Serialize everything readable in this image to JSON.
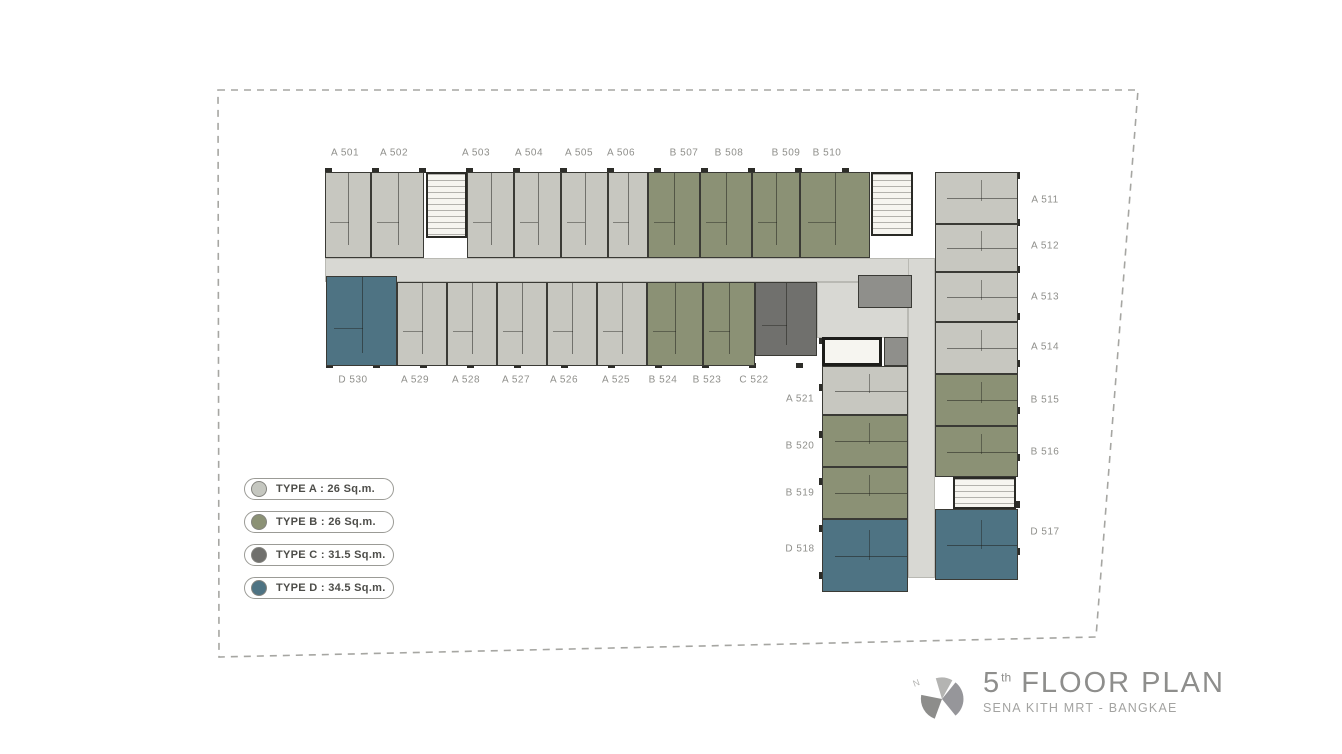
{
  "titleblock": {
    "floor_number": "5",
    "floor_suffix": "th",
    "floor_label": " FLOOR PLAN",
    "project_name": "SENA KITH MRT - BANGKAE",
    "logo_name": "sena-pinwheel-logo"
  },
  "legend": {
    "items": [
      {
        "type": "A",
        "label": "TYPE A : 26 Sq.m.",
        "color": "#c5c7c0"
      },
      {
        "type": "B",
        "label": "TYPE B : 26 Sq.m.",
        "color": "#8b9175"
      },
      {
        "type": "C",
        "label": "TYPE C : 31.5 Sq.m.",
        "color": "#70706d"
      },
      {
        "type": "D",
        "label": "TYPE D : 34.5 Sq.m.",
        "color": "#4e7383"
      }
    ]
  },
  "plan": {
    "colors": {
      "A": "#c7c7c0",
      "B": "#8b9175",
      "C": "#70706d",
      "D": "#4e7383",
      "corridor": "#d8d8d3",
      "core": "#f6f5f0",
      "wall": "#30302c"
    },
    "corridors": [
      {
        "x": 325,
        "y": 258,
        "w": 610,
        "h": 24
      },
      {
        "x": 908,
        "y": 258,
        "w": 27,
        "h": 320
      },
      {
        "x": 817,
        "y": 282,
        "w": 91,
        "h": 56
      }
    ],
    "units": [
      {
        "id": "A501",
        "type": "A",
        "o": "h",
        "x": 325,
        "y": 172,
        "w": 46,
        "h": 86
      },
      {
        "id": "A502",
        "type": "A",
        "o": "h",
        "x": 371,
        "y": 172,
        "w": 53,
        "h": 86
      },
      {
        "id": "A503",
        "type": "A",
        "o": "h",
        "x": 467,
        "y": 172,
        "w": 47,
        "h": 86
      },
      {
        "id": "A504",
        "type": "A",
        "o": "h",
        "x": 514,
        "y": 172,
        "w": 47,
        "h": 86
      },
      {
        "id": "A505",
        "type": "A",
        "o": "h",
        "x": 561,
        "y": 172,
        "w": 47,
        "h": 86
      },
      {
        "id": "A506",
        "type": "A",
        "o": "h",
        "x": 608,
        "y": 172,
        "w": 40,
        "h": 86
      },
      {
        "id": "B507",
        "type": "B",
        "o": "h",
        "x": 648,
        "y": 172,
        "w": 52,
        "h": 86
      },
      {
        "id": "B508",
        "type": "B",
        "o": "h",
        "x": 700,
        "y": 172,
        "w": 52,
        "h": 86
      },
      {
        "id": "B509",
        "type": "B",
        "o": "h",
        "x": 752,
        "y": 172,
        "w": 48,
        "h": 86
      },
      {
        "id": "B510",
        "type": "B",
        "o": "h",
        "x": 800,
        "y": 172,
        "w": 70,
        "h": 86
      },
      {
        "id": "A511",
        "type": "A",
        "o": "v",
        "x": 935,
        "y": 172,
        "w": 83,
        "h": 52
      },
      {
        "id": "A512",
        "type": "A",
        "o": "v",
        "x": 935,
        "y": 224,
        "w": 83,
        "h": 48
      },
      {
        "id": "A513",
        "type": "A",
        "o": "v",
        "x": 935,
        "y": 272,
        "w": 83,
        "h": 50
      },
      {
        "id": "A514",
        "type": "A",
        "o": "v",
        "x": 935,
        "y": 322,
        "w": 83,
        "h": 52
      },
      {
        "id": "B515",
        "type": "B",
        "o": "v",
        "x": 935,
        "y": 374,
        "w": 83,
        "h": 52
      },
      {
        "id": "B516",
        "type": "B",
        "o": "v",
        "x": 935,
        "y": 426,
        "w": 83,
        "h": 51
      },
      {
        "id": "D517",
        "type": "D",
        "o": "v",
        "x": 935,
        "y": 509,
        "w": 83,
        "h": 71
      },
      {
        "id": "A521",
        "type": "A",
        "o": "v",
        "x": 822,
        "y": 366,
        "w": 86,
        "h": 49
      },
      {
        "id": "B520",
        "type": "B",
        "o": "v",
        "x": 822,
        "y": 415,
        "w": 86,
        "h": 52
      },
      {
        "id": "B519",
        "type": "B",
        "o": "v",
        "x": 822,
        "y": 467,
        "w": 86,
        "h": 52
      },
      {
        "id": "D518",
        "type": "D",
        "o": "v",
        "x": 822,
        "y": 519,
        "w": 86,
        "h": 73
      },
      {
        "id": "C522",
        "type": "C",
        "o": "h",
        "x": 755,
        "y": 282,
        "w": 62,
        "h": 74
      },
      {
        "id": "B523",
        "type": "B",
        "o": "h",
        "x": 703,
        "y": 282,
        "w": 52,
        "h": 84
      },
      {
        "id": "B524",
        "type": "B",
        "o": "h",
        "x": 647,
        "y": 282,
        "w": 56,
        "h": 84
      },
      {
        "id": "A525",
        "type": "A",
        "o": "h",
        "x": 597,
        "y": 282,
        "w": 50,
        "h": 84
      },
      {
        "id": "A526",
        "type": "A",
        "o": "h",
        "x": 547,
        "y": 282,
        "w": 50,
        "h": 84
      },
      {
        "id": "A527",
        "type": "A",
        "o": "h",
        "x": 497,
        "y": 282,
        "w": 50,
        "h": 84
      },
      {
        "id": "A528",
        "type": "A",
        "o": "h",
        "x": 447,
        "y": 282,
        "w": 50,
        "h": 84
      },
      {
        "id": "A529",
        "type": "A",
        "o": "h",
        "x": 397,
        "y": 282,
        "w": 50,
        "h": 84
      },
      {
        "id": "D530",
        "type": "D",
        "o": "h",
        "x": 326,
        "y": 276,
        "w": 71,
        "h": 90
      }
    ],
    "cores": [
      {
        "id": "stair-core-top-left",
        "kind": "stair",
        "x": 426,
        "y": 172,
        "w": 41,
        "h": 66
      },
      {
        "id": "stair-core-top-right",
        "kind": "stair",
        "x": 871,
        "y": 172,
        "w": 42,
        "h": 64
      },
      {
        "id": "mech-room",
        "kind": "mech",
        "x": 858,
        "y": 275,
        "w": 54,
        "h": 33
      },
      {
        "id": "stair-core-mid",
        "kind": "heavy",
        "x": 822,
        "y": 337,
        "w": 60,
        "h": 29
      },
      {
        "id": "shaft",
        "kind": "mech",
        "x": 884,
        "y": 337,
        "w": 24,
        "h": 29
      },
      {
        "id": "stair-core-right",
        "kind": "stair",
        "x": 953,
        "y": 477,
        "w": 63,
        "h": 32
      }
    ],
    "labels": [
      {
        "t": "A 501",
        "x": 345,
        "y": 153
      },
      {
        "t": "A 502",
        "x": 394,
        "y": 153
      },
      {
        "t": "A 503",
        "x": 476,
        "y": 153
      },
      {
        "t": "A 504",
        "x": 529,
        "y": 153
      },
      {
        "t": "A 505",
        "x": 579,
        "y": 153
      },
      {
        "t": "A 506",
        "x": 621,
        "y": 153
      },
      {
        "t": "B 507",
        "x": 684,
        "y": 153
      },
      {
        "t": "B 508",
        "x": 729,
        "y": 153
      },
      {
        "t": "B 509",
        "x": 786,
        "y": 153
      },
      {
        "t": "B 510",
        "x": 827,
        "y": 153
      },
      {
        "t": "A 511",
        "x": 1045,
        "y": 200
      },
      {
        "t": "A 512",
        "x": 1045,
        "y": 246
      },
      {
        "t": "A 513",
        "x": 1045,
        "y": 297
      },
      {
        "t": "A 514",
        "x": 1045,
        "y": 347
      },
      {
        "t": "B 515",
        "x": 1045,
        "y": 400
      },
      {
        "t": "B 516",
        "x": 1045,
        "y": 452
      },
      {
        "t": "D 517",
        "x": 1045,
        "y": 532
      },
      {
        "t": "D 530",
        "x": 353,
        "y": 380
      },
      {
        "t": "A 529",
        "x": 415,
        "y": 380
      },
      {
        "t": "A 528",
        "x": 466,
        "y": 380
      },
      {
        "t": "A 527",
        "x": 516,
        "y": 380
      },
      {
        "t": "A 526",
        "x": 564,
        "y": 380
      },
      {
        "t": "A 525",
        "x": 616,
        "y": 380
      },
      {
        "t": "B 524",
        "x": 663,
        "y": 380
      },
      {
        "t": "B 523",
        "x": 707,
        "y": 380
      },
      {
        "t": "C 522",
        "x": 754,
        "y": 380
      },
      {
        "t": "A 521",
        "x": 800,
        "y": 399
      },
      {
        "t": "B 520",
        "x": 800,
        "y": 446
      },
      {
        "t": "B 519",
        "x": 800,
        "y": 493
      },
      {
        "t": "D 518",
        "x": 800,
        "y": 549
      }
    ]
  }
}
